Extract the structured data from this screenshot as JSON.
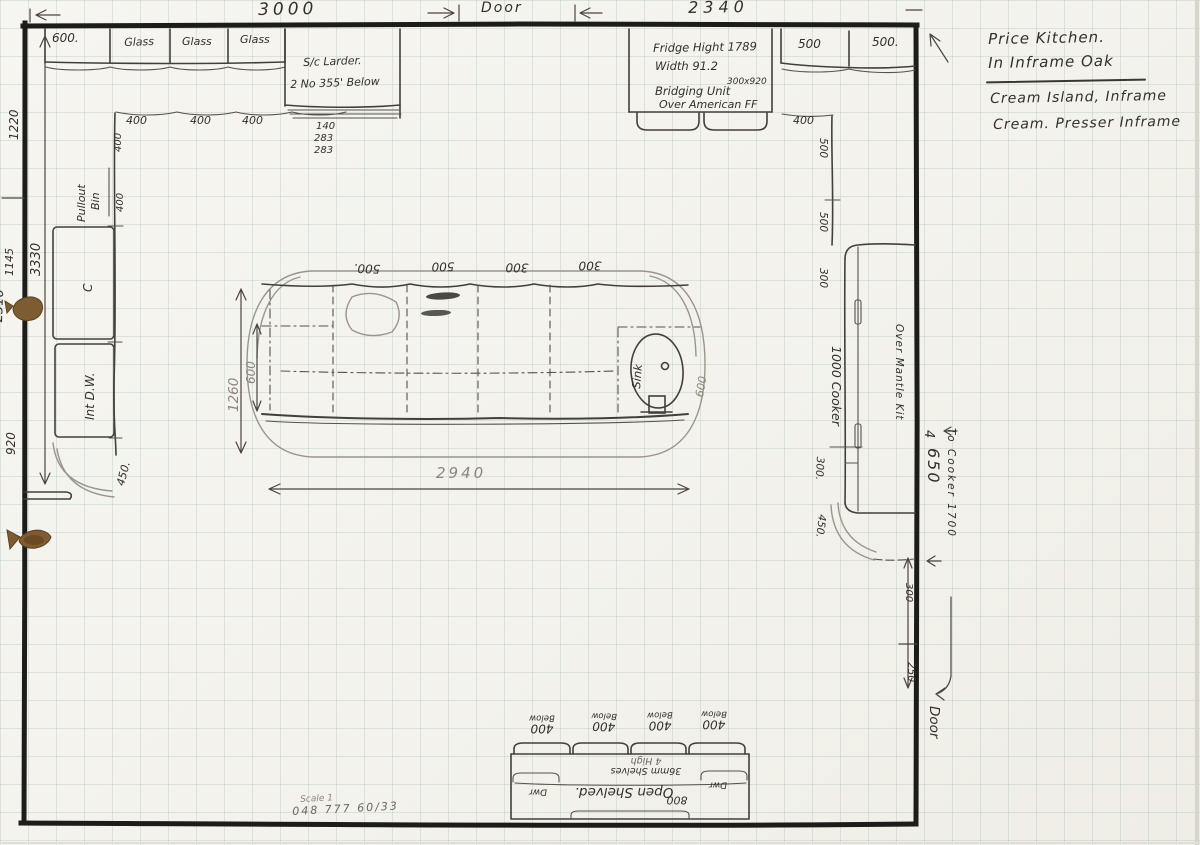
{
  "colors": {
    "paper": "#f4f3ed",
    "ink": "#33302a",
    "pencil": "#8b877c",
    "wall": "#1d1c19",
    "stain": "#7d5c33"
  },
  "header": {
    "dim_3000": "3000",
    "door_label": "Door",
    "dim_2340": "2340"
  },
  "notes": {
    "line1": "Price Kitchen.",
    "line2": "In Inframe Oak",
    "line3": "Cream Island, Inframe",
    "line4": "Cream. Presser Inframe"
  },
  "top_run": {
    "cab_600": "600.",
    "glass_1": "Glass",
    "glass_2": "Glass",
    "glass_3": "Glass",
    "larder_1": "S/c Larder.",
    "larder_2": "2 No 355' Below",
    "stack_1": "140",
    "stack_2": "283",
    "stack_3": "283",
    "dim_400_1": "400",
    "dim_400_2": "400",
    "dim_400_3": "400"
  },
  "left_run": {
    "dim_400_v1": "400",
    "dim_400_v2": "400",
    "pullout_1": "Pullout",
    "pullout_2": "Bin",
    "unit_c": "C",
    "int_dw": "Int D.W.",
    "corner_450": "450."
  },
  "left_dims": {
    "d_1220": "1220",
    "d_3330": "3330",
    "d_1145": "1145",
    "d_2310": "2310",
    "d_920": "920"
  },
  "fridge": {
    "line1": "Fridge Hight 1789",
    "line2": "Width 91.2",
    "line3": "Bridging Unit",
    "line3_sup": "300x920",
    "line4": "Over American FF"
  },
  "right_top": {
    "cab_500_1": "500",
    "cab_500_2": "500."
  },
  "right_run": {
    "dim_400": "400",
    "dim_500_1": "500",
    "dim_500_2": "500",
    "dim_300": "300",
    "cooker": "1000 Cooker",
    "dim_300b": "300.",
    "dim_450": "450.",
    "mantle": "Over Mantle Kit"
  },
  "right_dims": {
    "d_4": "4",
    "d_650": "650",
    "to_cooker": "To Cooker 1700",
    "d_300": "300",
    "d_250": "250",
    "door_label": "Door"
  },
  "island": {
    "top_500a": "500.",
    "top_500b": "500",
    "top_300a": "300",
    "top_300b": "300",
    "sink": "Sink",
    "dim_1260": "1260",
    "dim_600_left": "600",
    "dim_600_right": "600",
    "dim_2940": "2940"
  },
  "dresser": {
    "labels": [
      {
        "num": "400",
        "txt": "Below"
      },
      {
        "num": "400",
        "txt": "Below"
      },
      {
        "num": "400",
        "txt": "Below"
      },
      {
        "num": "400",
        "txt": "Below"
      }
    ],
    "shelves_1": "36mm Shelves",
    "shelves_2": "4 High",
    "open": "Open Shelved.",
    "num_800": "800",
    "dwr_left": "Dwr",
    "dwr_right": "Dwr"
  },
  "footer": {
    "scale": "Scale 1",
    "number": "048 777 60/33"
  }
}
